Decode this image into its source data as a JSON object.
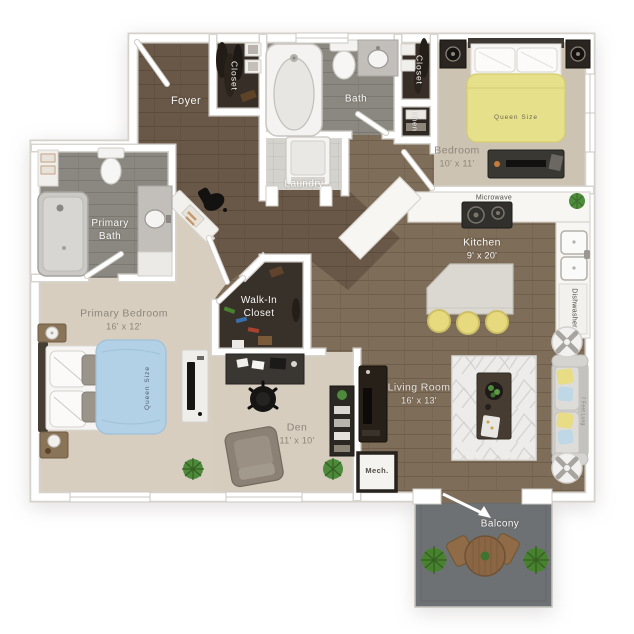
{
  "plan": {
    "rooms": {
      "foyer": {
        "label": "Foyer"
      },
      "foyerCloset": {
        "label": "Closet"
      },
      "bath": {
        "label": "Bath"
      },
      "linen": {
        "label": "Linen"
      },
      "laundry": {
        "label": "Laundry"
      },
      "bedroomCloset": {
        "label": "Closet"
      },
      "bedroom": {
        "label": "Bedroom",
        "dims": "10' x 11'"
      },
      "kitchen": {
        "label": "Kitchen",
        "dims": "9' x 20'"
      },
      "primaryBath": {
        "label": "Primary Bath"
      },
      "primaryBedroom": {
        "label": "Primary Bedroom",
        "dims": "16' x 12'"
      },
      "walkInCloset": {
        "label": "Walk-In Closet"
      },
      "den": {
        "label": "Den",
        "dims": "11' x 10'"
      },
      "mech": {
        "label": "Mech."
      },
      "livingRoom": {
        "label": "Living Room",
        "dims": "16' x 13'"
      },
      "balcony": {
        "label": "Balcony"
      }
    },
    "appliances": {
      "microwave": "Microwave",
      "dishwasher": "Dishwasher"
    },
    "furniture_tags": {
      "bedroomBed": "Queen Size",
      "primaryBed": "Queen Size",
      "sofa": "7 Feet Long"
    },
    "colors": {
      "wood_main": "#7e6d59",
      "wood_dark": "#6a594a",
      "bath_tile": "#8b8882",
      "carpet": "#d5ccbc",
      "closet_dark": "#372f27",
      "balcony_floor": "#6e7173",
      "bed_yellow": "#e7e08b",
      "bed_blue": "#b3d1e6",
      "stool_yellow": "#e6d97e",
      "plant_green": "#4d8a3b",
      "wall_white": "#ffffff"
    }
  }
}
